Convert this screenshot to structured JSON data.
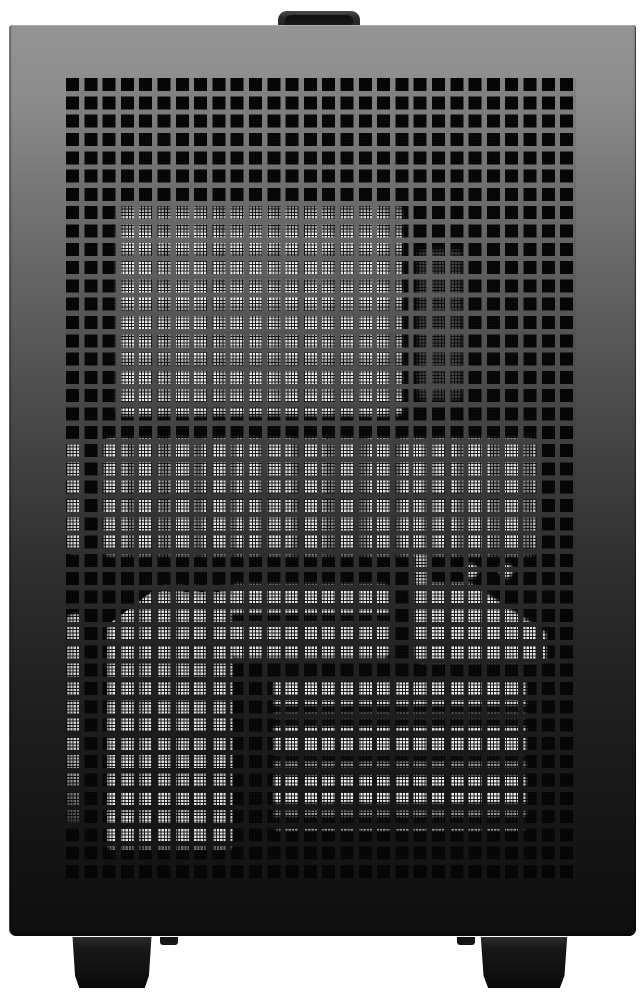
{
  "scene": {
    "subject": "Compact black PC tower case, front view product photo",
    "description": "Black mini-tower computer case with full perforated square-hole mesh front panel, small carrying handle on top, two block feet at the bottom, photographed on a plain white background. Light falls from above: the chassis fades from light gray at the top to near black at the bottom. Internal components (fans, radiator, power supply fins, cables) show through the mesh as bright white cell patterns.",
    "visible_text": "",
    "regions": [
      {
        "name": "top-fan-radiator-glow",
        "desc": "large bright grid patch, upper center"
      },
      {
        "name": "mid-bright-band",
        "desc": "wide bright band across middle"
      },
      {
        "name": "left-edge-column",
        "desc": "single bright column of cells at far left"
      },
      {
        "name": "lower-left-block",
        "desc": "tall bright block with clipped corner"
      },
      {
        "name": "lower-psu-fins",
        "desc": "horizontally banded bright stripes lower center-right"
      },
      {
        "name": "cable-silhouette",
        "desc": "dark diagonal across bright patch, mid right"
      }
    ]
  },
  "mesh": {
    "columns": 28,
    "rows": 44,
    "hole_px": 13,
    "pitch_px": 18.3,
    "sub_pitch_px": 3.26
  },
  "css_vars": {
    "page_bg": "#ffffff",
    "case_top": "#949494",
    "case_upper": "#6f6f6f",
    "case_mid": "#3f3f3f",
    "case_low": "#232323",
    "case_bottom": "#0f0f0f",
    "panel_top": "#838383",
    "panel_mid": "#363636",
    "panel_bottom": "#141414",
    "interior": "#0a0a0a",
    "glow_bright": "#ececec",
    "glow_dim": "#9a9a9a",
    "handle": "#242424",
    "foot": "#121212",
    "pitch": "18.3px",
    "hole": "13px",
    "subpitch": "3.26px"
  }
}
